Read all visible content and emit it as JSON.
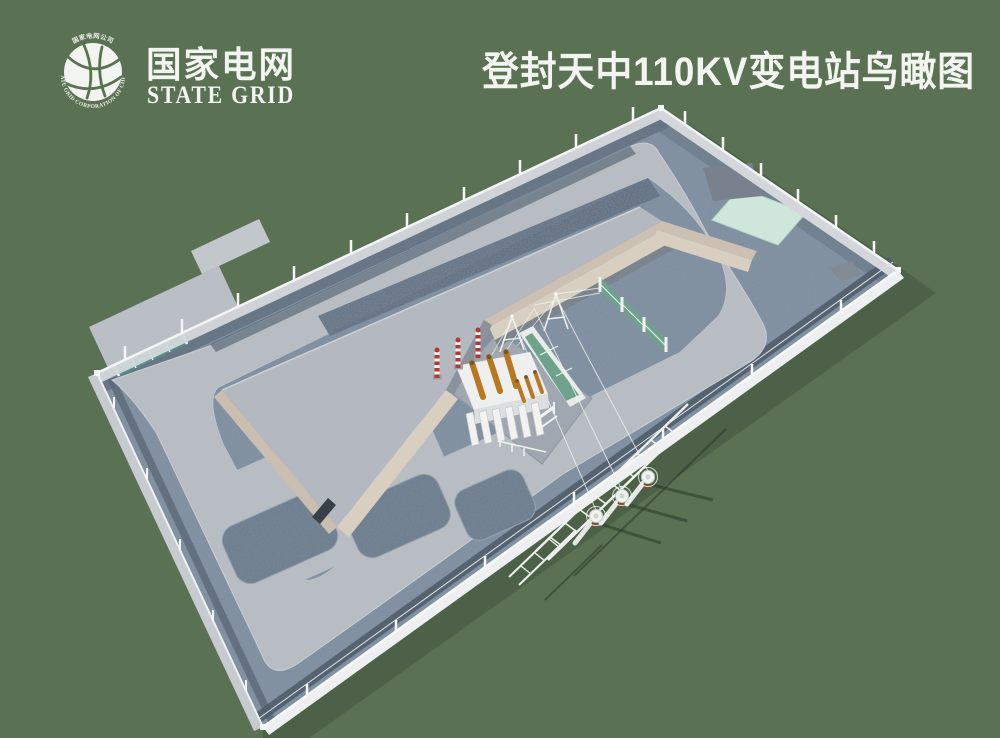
{
  "header": {
    "title": "登封天中110KV变电站鸟瞰图",
    "logo": {
      "name_cn": "国家电网",
      "name_en": "STATE GRID",
      "ring_text_top": "国家电网公司",
      "ring_text_bottom": "STATE GRID CORPORATION OF CHINA"
    }
  },
  "colors": {
    "background": "#5b7153",
    "shadow": "#4c6147",
    "gravel": "#8493a3",
    "gravel_dark": "#64738322",
    "gravel_strip": "#5f6e7e",
    "road": "#b8bdc4",
    "roof": "#b4b9c1",
    "wall_beige": "#d9cfc1",
    "wall_beige_dark": "#c9beb0",
    "gate_teal": "#4f9486",
    "mint": "#cfe7db",
    "panel_green": "#6fa28d",
    "bushing_orange": "#b9771f",
    "arrester_red": "#b23a32",
    "pole_brown": "#7d4f33",
    "structure_white": "#eef0ee",
    "fence_light": "#d3d7db",
    "text_white": "#f3f5f0"
  }
}
